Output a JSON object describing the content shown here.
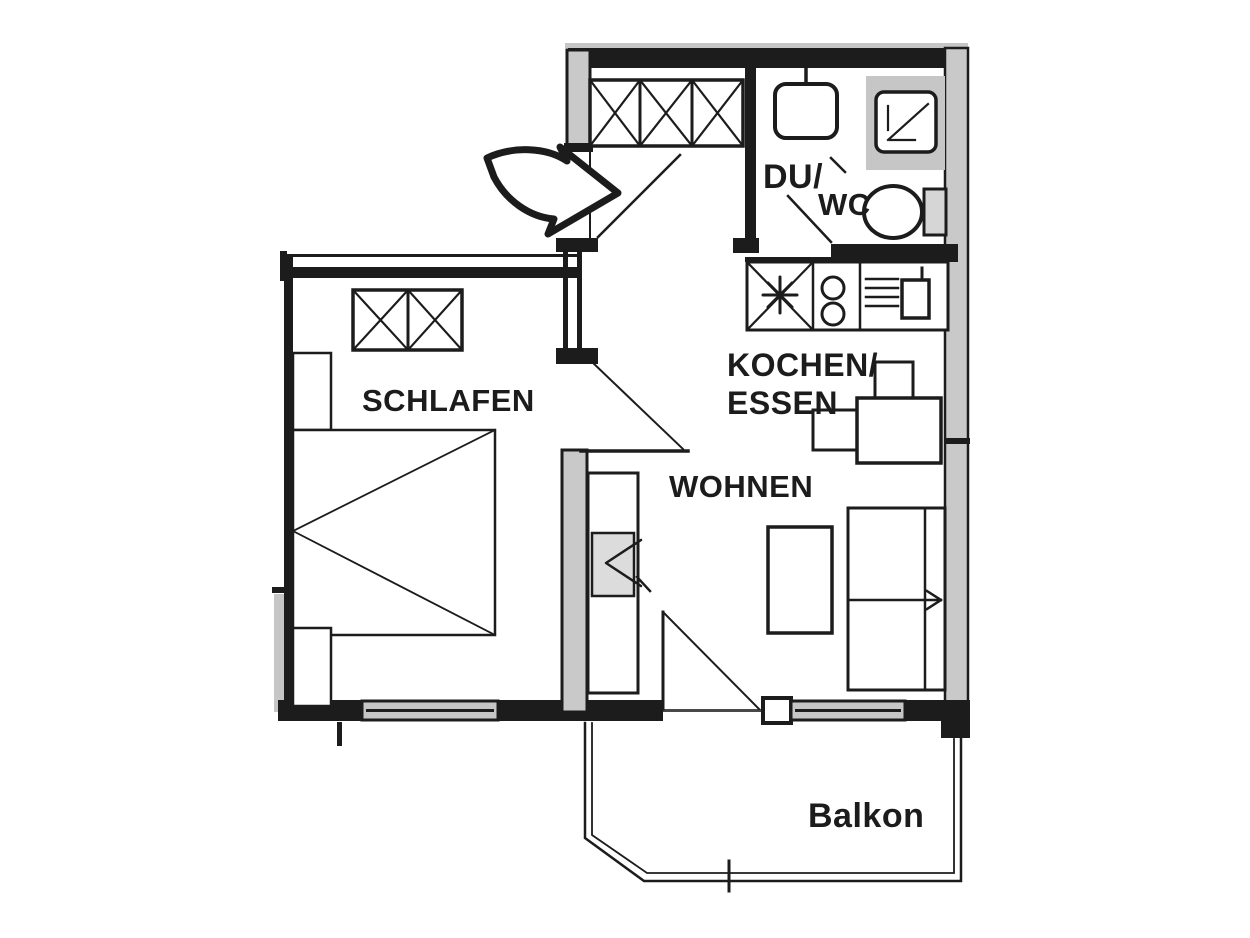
{
  "labels": {
    "bedroom": "SCHLAFEN",
    "living": "WOHNEN",
    "kitchen_line1": "KOCHEN/",
    "kitchen_line2": "ESSEN",
    "bath_line1": "DU/",
    "bath_line2": "WC",
    "balcony": "Balkon"
  },
  "colors": {
    "line": "#1c1c1c",
    "wall_fill": "#c9c9c9",
    "window_fill": "#c6c6c6",
    "tv_fill": "#dcdcdc",
    "cistern_fill": "#d6d6d6",
    "background": "#ffffff"
  },
  "fixtures": [
    "entrance-arrow-icon",
    "entrance-door-swing",
    "hall-wardrobe-icon",
    "washbasin-icon",
    "shower-icon",
    "toilet-icon",
    "bathroom-door-swing",
    "kitchen-counter",
    "fridge-snowflake-icon",
    "cooktop-burners-icon",
    "kitchen-sink-icon",
    "dining-table",
    "dining-chair",
    "bedroom-wardrobe-icon",
    "dresser",
    "bed-icon",
    "nightstand",
    "bedroom-door-swing",
    "tv-sideboard",
    "tv-icon",
    "coffee-table",
    "sofa-icon",
    "balcony-door-swing",
    "balcony-railing",
    "window-band"
  ]
}
